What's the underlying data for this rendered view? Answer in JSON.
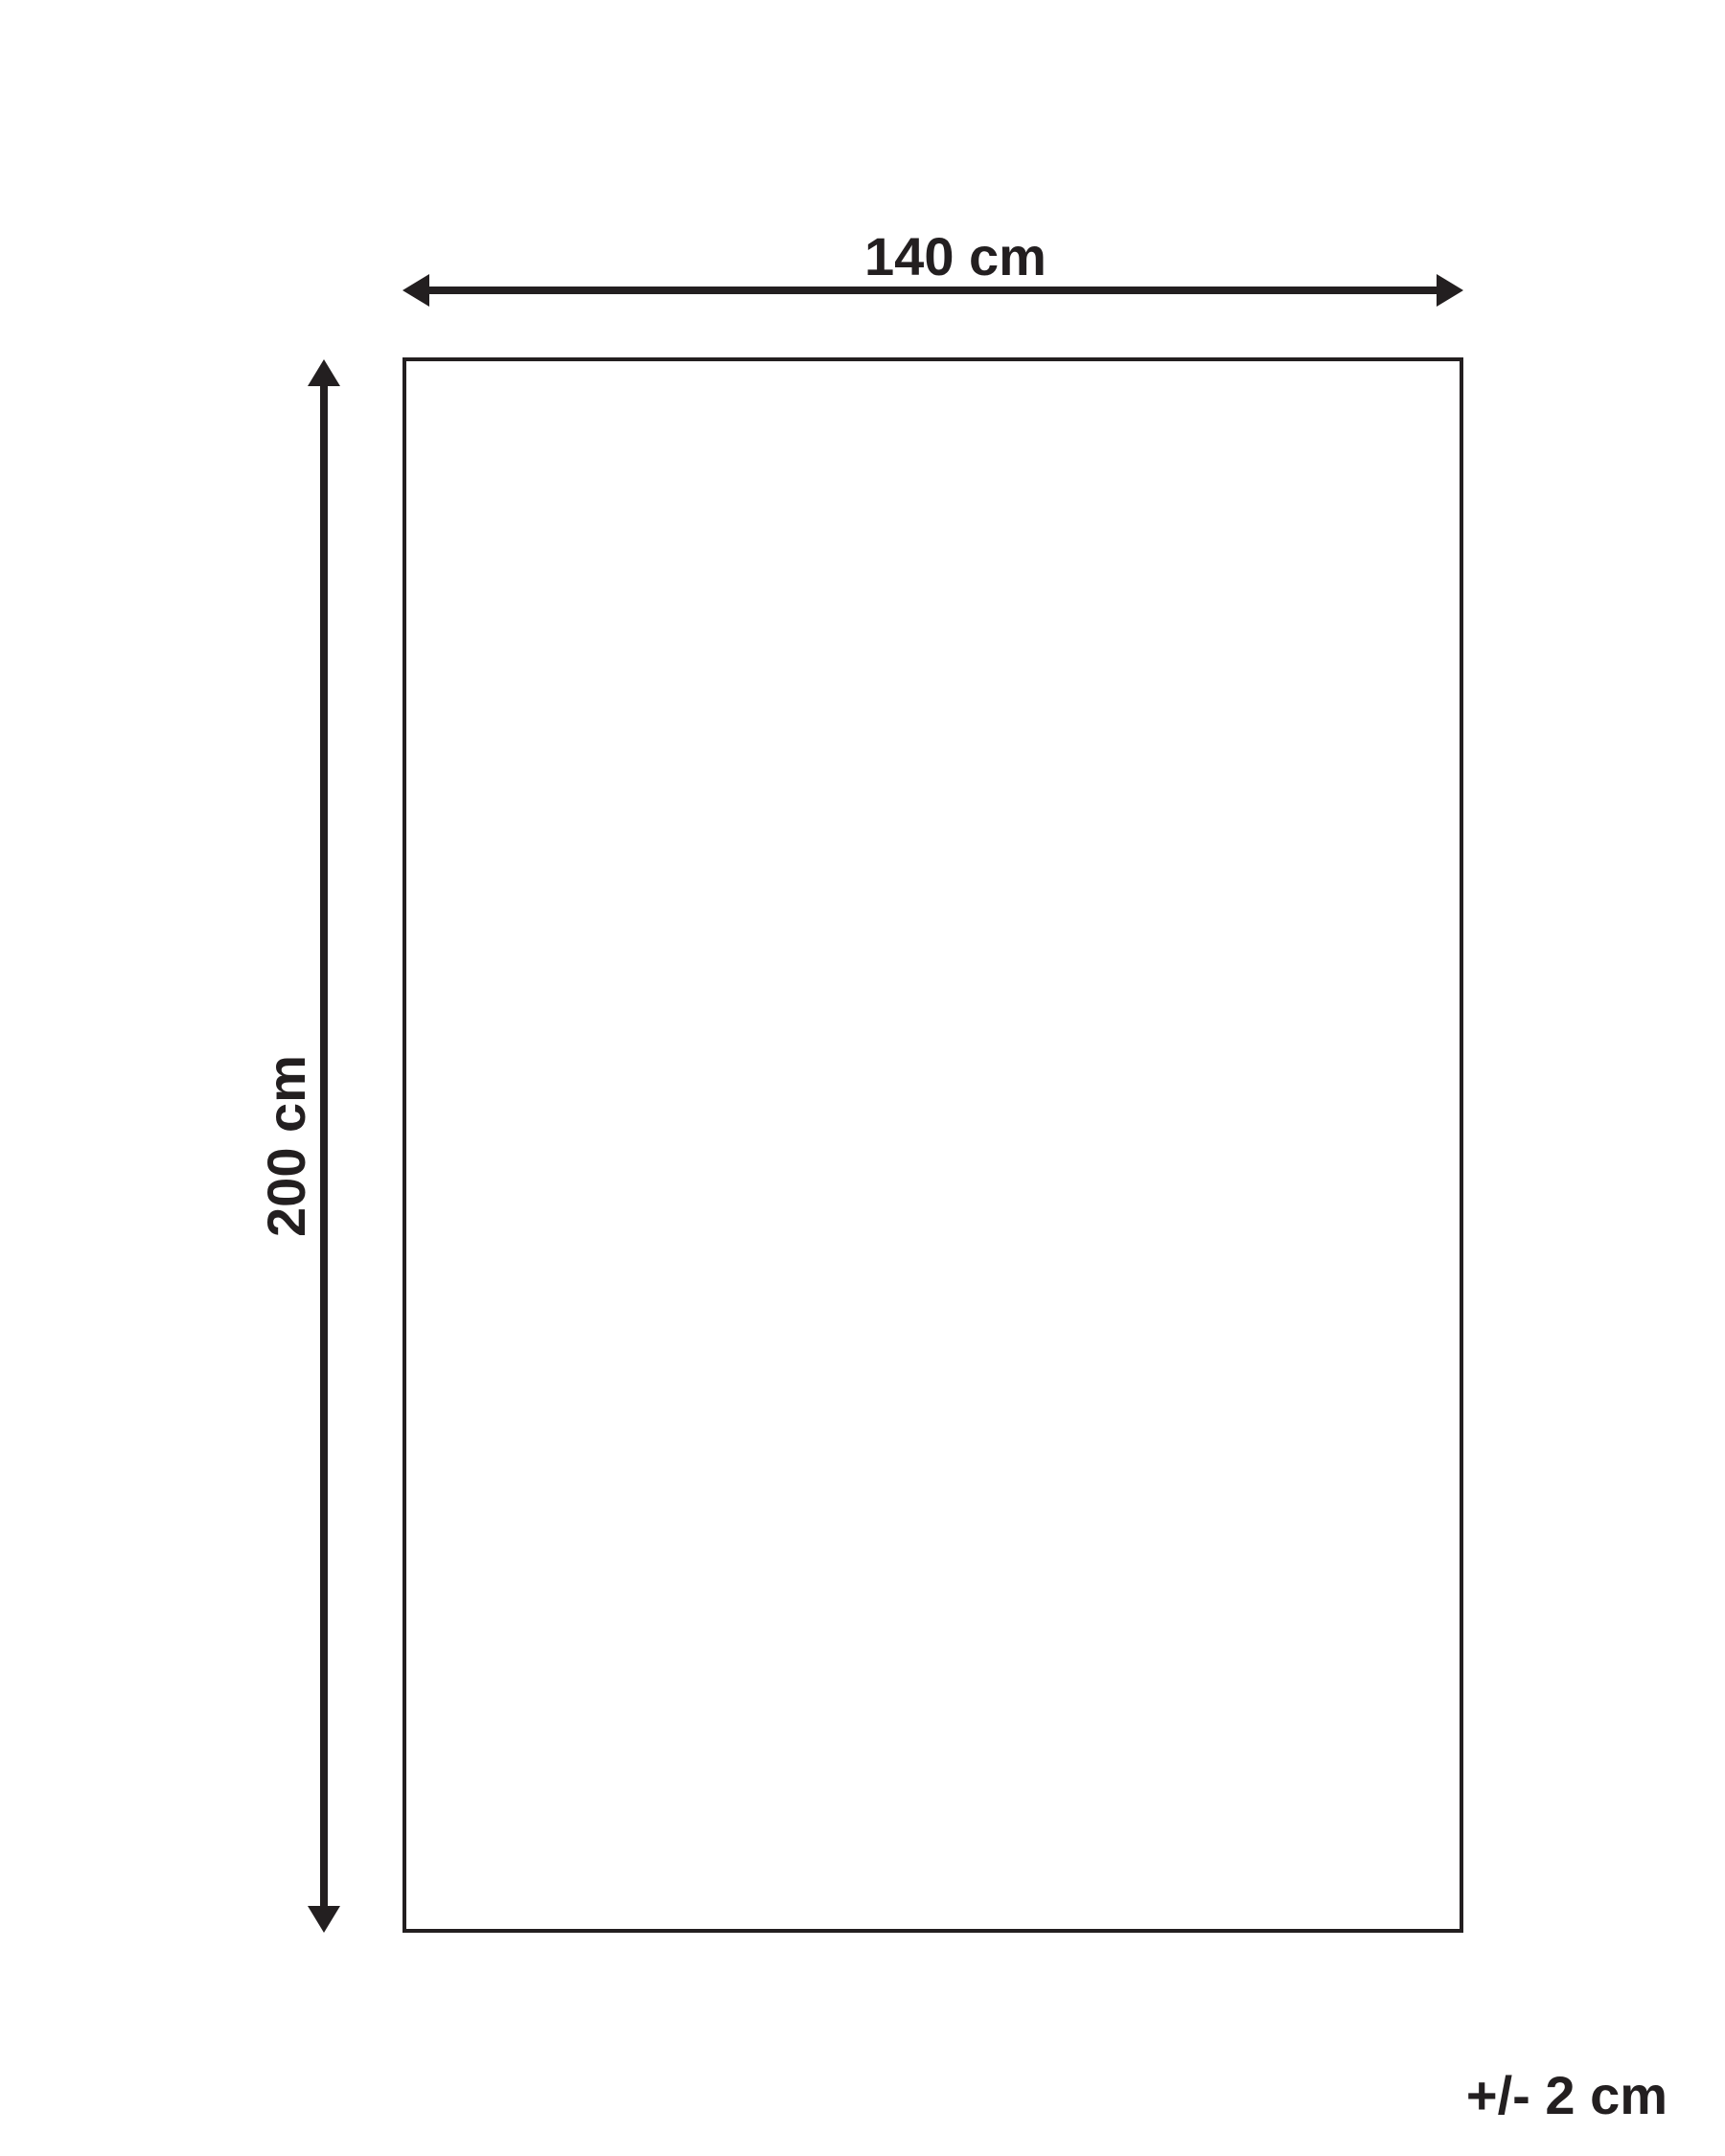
{
  "diagram": {
    "type": "product-dimension-diagram",
    "background_color": "#ffffff",
    "ink_color": "#231f20",
    "labels": {
      "width": "140 cm",
      "height": "200 cm",
      "tolerance": "+/- 2 cm"
    },
    "dimensions": {
      "width_cm": 140,
      "height_cm": 200,
      "tolerance_cm": 2
    },
    "icons": {
      "width_arrow": "horizontal-double-arrow-icon",
      "height_arrow": "vertical-double-arrow-icon"
    }
  }
}
